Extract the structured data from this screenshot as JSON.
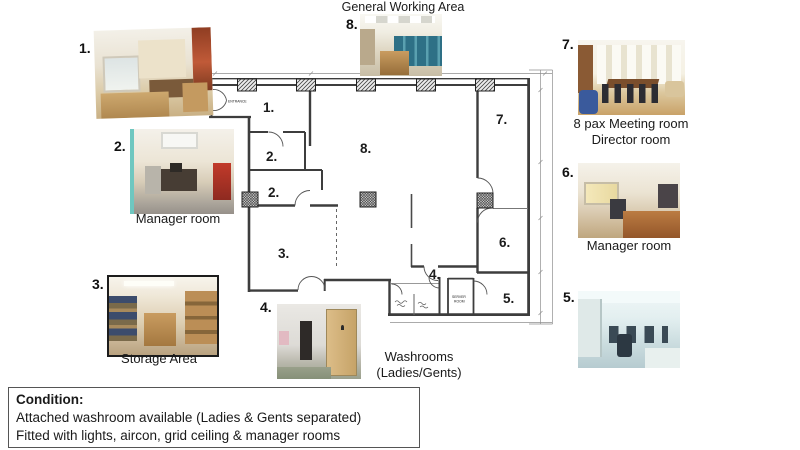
{
  "page": {
    "title": "General Working Area"
  },
  "photos": {
    "p1": {
      "label": "1."
    },
    "p2": {
      "label": "2.",
      "caption": "Manager room"
    },
    "p3": {
      "label": "3.",
      "caption": "Storage Area"
    },
    "p4": {
      "label": "4.",
      "caption1": "Washrooms",
      "caption2": "(Ladies/Gents)"
    },
    "p5": {
      "label": "5."
    },
    "p6": {
      "label": "6.",
      "caption": "Manager room"
    },
    "p7": {
      "label": "7.",
      "caption1": "8 pax Meeting room",
      "caption2": "Director room"
    },
    "p8": {
      "label": "8."
    }
  },
  "floorplan": {
    "rooms": {
      "r1": "1.",
      "r2a": "2.",
      "r2b": "2.",
      "r3": "3.",
      "r4": "4.",
      "r5": "5.",
      "r6": "6.",
      "r7": "7.",
      "r8": "8."
    },
    "entrance": "ENTRANCE",
    "server1": "SERVER",
    "server2": "ROOM"
  },
  "condition": {
    "heading": "Condition:",
    "lines": [
      "Attached washroom available (Ladies & Gents separated)",
      "Fitted with lights, aircon, grid ceiling & manager rooms"
    ]
  }
}
